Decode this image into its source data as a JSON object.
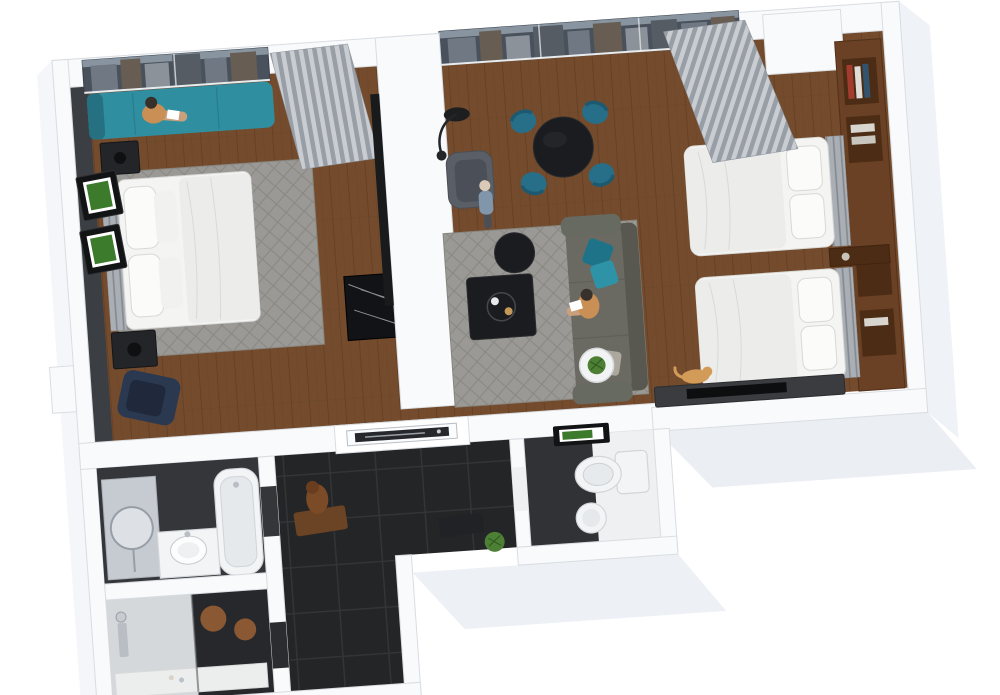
{
  "scene": {
    "description": "3D isometric top-down render of a two-bedroom hotel suite floor plan on a white background, rotated slightly counter-clockwise",
    "background": "#ffffff",
    "rotation_deg": -4
  },
  "colors": {
    "wall": "#f9fafb",
    "wall_edge": "#d9dde2",
    "wall_face": "#eff2f6",
    "wall_shadow": "#e7ebf1",
    "wood": "#744c2d",
    "wood_line": "#5a3820",
    "dark_wall": "#3b3e43",
    "tile": "#242527",
    "tile_line": "#333538",
    "rug": "#9b9995",
    "rug_accent": "#87857f",
    "linen": "#f4f4f2",
    "linen_edge": "#d8d9d7",
    "duvet": "#ececeb",
    "teal": "#2f8fa0",
    "teal_dark": "#257181",
    "chair_teal": "#276f88",
    "chair_teal_dark": "#1d5a70",
    "navy": "#2b3950",
    "navy_dark": "#20293c",
    "sofa": "#6b6a62",
    "sofa_dark": "#585750",
    "pillow_teal": "#2f93a8",
    "pillow_teal_dark": "#1f7389",
    "pillow_gray": "#aca89d",
    "table_black": "#1b1c1f",
    "curtain": "#989ea6",
    "curtain_light": "#c9cdd2",
    "glass": "#49525c",
    "sky": "#93a0ac",
    "building_a": "#6f7883",
    "building_b": "#8c929a",
    "building_c": "#675d52",
    "building_d": "#555c64",
    "wood_shelf": "#6a4124",
    "wood_shelf_dark": "#4c2c15",
    "headboard": "#aaafb5",
    "marble": "#121316",
    "marble_vein": "#cdd2d8",
    "porcelain": "#f3f4f5",
    "porcelain_edge": "#d2d6da",
    "tub_inner": "#e6e9ec",
    "mirror_glass": "#c6cbd1",
    "fixture": "#b9bec5",
    "skin": "#c9a07b",
    "hair_dark": "#38302a",
    "shirt_orange": "#c98f55",
    "shirt_blue": "#8196ab",
    "pants": "#4a4f57",
    "statue": "#7b4a27",
    "mat": "#6b4325",
    "plant": "#4d7f35",
    "plant_dark": "#315c22",
    "stool": "#8a5832",
    "stool_dark": "#5f3a1d",
    "art_green": "#3c7a2c",
    "frame_dark": "#121315",
    "cat": "#d29c58"
  },
  "rooms": [
    {
      "name": "bedroom-1",
      "floor": "wood",
      "features": [
        "city-view-window",
        "window-bench",
        "curtain",
        "king-bed",
        "headboard",
        "pillows",
        "area-rug",
        "nightstand-top",
        "nightstand-bottom",
        "wall-art-green-1",
        "wall-art-green-2",
        "navy-lounge-chair",
        "marble-console",
        "wardrobe-column",
        "dark-accent-wall"
      ]
    },
    {
      "name": "living-dining-room",
      "floor": "wood",
      "features": [
        "city-view-window",
        "round-dining-table",
        "dining-chairs-teal-x4",
        "floor-lamp",
        "gray-armchair",
        "area-rug",
        "round-side-table",
        "square-coffee-table",
        "sofa",
        "teal-pillows",
        "plant-side-table"
      ]
    },
    {
      "name": "bedroom-2",
      "floor": "wood",
      "features": [
        "curtain",
        "white-wardrobe",
        "wood-shelf-wall",
        "bed-upper",
        "bed-lower",
        "headboards",
        "nightstand-shelf",
        "media-console",
        "cat"
      ]
    },
    {
      "name": "bathroom",
      "floor": "dark-tile",
      "features": [
        "mirror-panel",
        "round-mirror",
        "vanity",
        "round-sink",
        "bathtub"
      ]
    },
    {
      "name": "shower-room",
      "floor": "mixed-tile",
      "features": [
        "walk-in-shower",
        "shower-fixture",
        "glass-partition",
        "wood-stool-large",
        "wood-stool-small",
        "toiletries"
      ]
    },
    {
      "name": "toilet-room",
      "floor": "white",
      "features": [
        "toilet",
        "round-sink",
        "green-wall-art",
        "dark-accent-wall"
      ]
    },
    {
      "name": "entry-hall",
      "floor": "dark-tile",
      "features": [
        "entry-door",
        "bronze-statue",
        "floor-mat",
        "dark-bench",
        "potted-plant"
      ]
    }
  ],
  "people": [
    {
      "name": "person-on-window-bench",
      "pose": "sitting-reading",
      "location": "bedroom-1"
    },
    {
      "name": "person-standing",
      "pose": "standing",
      "location": "living-dining-room"
    },
    {
      "name": "person-on-sofa",
      "pose": "sitting-reading",
      "location": "living-dining-room"
    }
  ],
  "pets": [
    {
      "name": "cat",
      "location": "bedroom-2"
    }
  ]
}
